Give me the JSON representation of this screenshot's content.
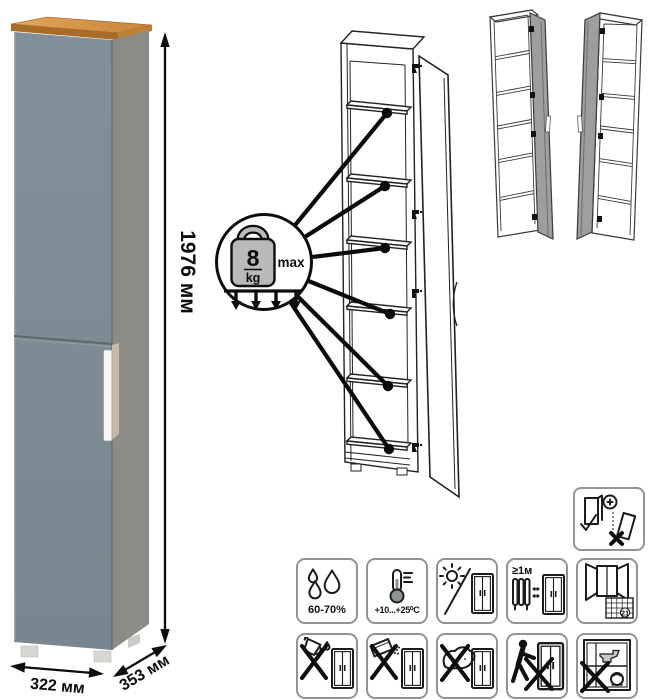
{
  "dimensions": {
    "height": "1976 мм",
    "width": "322 мм",
    "depth": "353 мм"
  },
  "load_callout": {
    "value": "8",
    "unit": "kg",
    "max_label": "max"
  },
  "care_icons": {
    "humidity": {
      "icon": "water-drops-icon",
      "label": "60-70%"
    },
    "temperature": {
      "icon": "thermometer-icon",
      "label": "+10...+25⁰C"
    },
    "sunlight": {
      "icon": "sun-crossed-wardrobe-icon"
    },
    "heat_distance": {
      "icon": "radiator-distance-wardrobe-icon",
      "label": "≥1м"
    },
    "ventilation": {
      "icon": "open-window-calendar-icon",
      "calendar_day": "21"
    },
    "no_liquids": {
      "icon": "no-pouring-liquids-icon"
    },
    "no_abrasives": {
      "icon": "no-abrasive-powder-icon"
    },
    "no_scrubbing": {
      "icon": "no-sponge-icon"
    },
    "no_dragging": {
      "icon": "no-dragging-person-icon"
    },
    "no_overload": {
      "icon": "no-heavy-items-icon"
    }
  },
  "safety_icon": {
    "icon": "anchor-to-wall-icon"
  },
  "colors": {
    "front_panel": "#7e8b93",
    "side_panel": "#8c8b86",
    "wood_top": "#c98439",
    "variant_door": "#9e9e9e",
    "outline": "#111111",
    "icon_border": "#8f9596"
  }
}
